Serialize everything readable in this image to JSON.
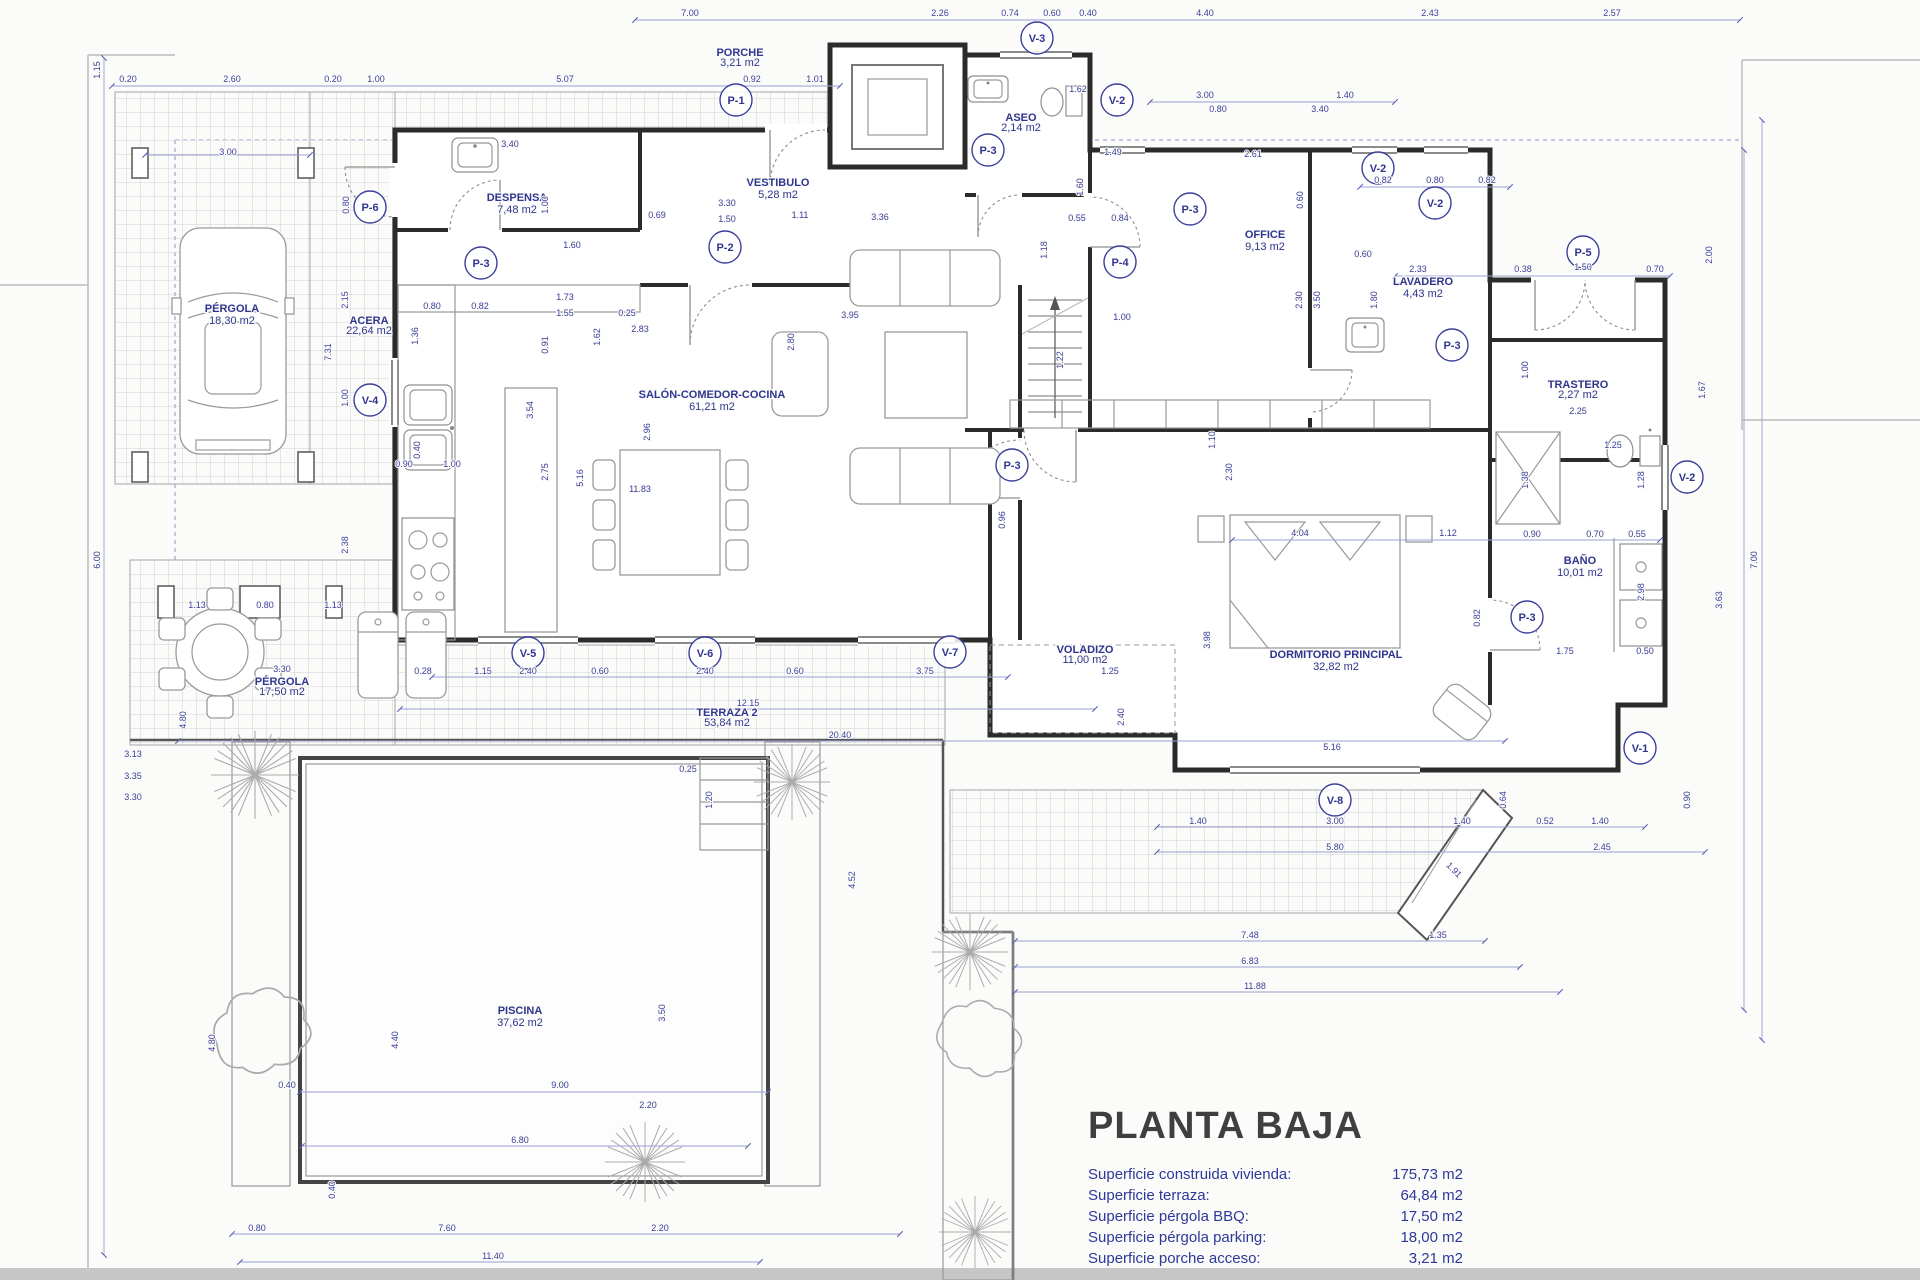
{
  "colors": {
    "annotation_blue": "#30368f",
    "dim_blue": "#3a3f99",
    "wall_dark": "#2b2b2b",
    "furniture_gray": "#9a9a9a",
    "tile_gray": "#d2d2d2",
    "background": "#fbfbfa"
  },
  "title_block": {
    "title": "PLANTA BAJA",
    "entries": [
      {
        "label": "Superficie construida vivienda:",
        "value": "175,73 m2"
      },
      {
        "label": "Superficie terraza:",
        "value": "64,84 m2"
      },
      {
        "label": "Superficie pérgola BBQ:",
        "value": "17,50 m2"
      },
      {
        "label": "Superficie pérgola parking:",
        "value": "18,00 m2"
      },
      {
        "label": "Superficie porche acceso:",
        "value": "3,21 m2"
      }
    ]
  },
  "rooms": [
    {
      "id": "porche",
      "n": "PORCHE",
      "a": "3,21 m2",
      "x": 740,
      "y": 56,
      "fs": 9
    },
    {
      "id": "vestibulo",
      "n": "VESTIBULO",
      "a": "5,28 m2",
      "x": 778,
      "y": 186
    },
    {
      "id": "despensa",
      "n": "DESPENSA",
      "a": "7,48 m2",
      "x": 517,
      "y": 201
    },
    {
      "id": "aseo",
      "n": "ASEO",
      "a": "2,14 m2",
      "x": 1021,
      "y": 121,
      "fs": 9
    },
    {
      "id": "office",
      "n": "OFFICE",
      "a": "9,13 m2",
      "x": 1265,
      "y": 238
    },
    {
      "id": "lavadero",
      "n": "LAVADERO",
      "a": "4,43 m2",
      "x": 1423,
      "y": 285
    },
    {
      "id": "trastero",
      "n": "TRASTERO",
      "a": "2,27 m2",
      "x": 1578,
      "y": 388,
      "fs": 9
    },
    {
      "id": "bano",
      "n": "BAÑO",
      "a": "10,01 m2",
      "x": 1580,
      "y": 564
    },
    {
      "id": "dormitorio",
      "n": "DORMITORIO PRINCIPAL",
      "a": "32,82 m2",
      "x": 1336,
      "y": 658
    },
    {
      "id": "salon",
      "n": "SALÓN-COMEDOR-COCINA",
      "a": "61,21 m2",
      "x": 712,
      "y": 398
    },
    {
      "id": "pergola-parking",
      "n": "PÉRGOLA",
      "a": "18,30 m2",
      "x": 232,
      "y": 312
    },
    {
      "id": "acera",
      "n": "ACERA",
      "a": "22,64 m2",
      "x": 369,
      "y": 324,
      "fs": 9
    },
    {
      "id": "pergola-bbq",
      "n": "PÉRGOLA",
      "a": "17,50 m2",
      "x": 282,
      "y": 685,
      "fs": 9
    },
    {
      "id": "terraza2",
      "n": "TERRAZA 2",
      "a": "53,84 m2",
      "x": 727,
      "y": 716,
      "fs": 9
    },
    {
      "id": "voladizo",
      "n": "VOLADIZO",
      "a": "11,00 m2",
      "x": 1085,
      "y": 653,
      "fs": 9
    },
    {
      "id": "piscina",
      "n": "PISCINA",
      "a": "37,62 m2",
      "x": 520,
      "y": 1014
    }
  ],
  "door_tags": [
    {
      "l": "P-1",
      "x": 736,
      "y": 100
    },
    {
      "l": "P-2",
      "x": 725,
      "y": 247
    },
    {
      "l": "P-3",
      "x": 481,
      "y": 263
    },
    {
      "l": "P-3",
      "x": 988,
      "y": 150
    },
    {
      "l": "P-3",
      "x": 1190,
      "y": 209
    },
    {
      "l": "P-3",
      "x": 1012,
      "y": 465
    },
    {
      "l": "P-3",
      "x": 1452,
      "y": 345
    },
    {
      "l": "P-3",
      "x": 1527,
      "y": 617
    },
    {
      "l": "P-4",
      "x": 1120,
      "y": 262
    },
    {
      "l": "P-5",
      "x": 1583,
      "y": 252
    },
    {
      "l": "P-6",
      "x": 370,
      "y": 207
    }
  ],
  "window_tags": [
    {
      "l": "V-1",
      "x": 1640,
      "y": 748
    },
    {
      "l": "V-2",
      "x": 1117,
      "y": 100
    },
    {
      "l": "V-2",
      "x": 1378,
      "y": 168
    },
    {
      "l": "V-2",
      "x": 1435,
      "y": 203
    },
    {
      "l": "V-2",
      "x": 1687,
      "y": 477
    },
    {
      "l": "V-3",
      "x": 1037,
      "y": 38
    },
    {
      "l": "V-4",
      "x": 370,
      "y": 400
    },
    {
      "l": "V-5",
      "x": 528,
      "y": 653
    },
    {
      "l": "V-6",
      "x": 705,
      "y": 653
    },
    {
      "l": "V-7",
      "x": 950,
      "y": 652
    },
    {
      "l": "V-8",
      "x": 1335,
      "y": 800
    }
  ],
  "dimensions": [
    [
      "7.00",
      690,
      16
    ],
    [
      "2.26",
      940,
      16
    ],
    [
      "0.74",
      1010,
      16
    ],
    [
      "0.60",
      1052,
      16
    ],
    [
      "0.40",
      1088,
      16
    ],
    [
      "4.40",
      1205,
      16
    ],
    [
      "2.43",
      1430,
      16
    ],
    [
      "2.57",
      1612,
      16
    ],
    [
      "0.20",
      128,
      82
    ],
    [
      "2.60",
      232,
      82
    ],
    [
      "0.20",
      333,
      82
    ],
    [
      "1.00",
      376,
      82
    ],
    [
      "5.07",
      565,
      82
    ],
    [
      "0.92",
      752,
      82
    ],
    [
      "1.01",
      815,
      82
    ],
    [
      "3.00",
      1205,
      98
    ],
    [
      "1.40",
      1345,
      98
    ],
    [
      "0.80",
      1218,
      112
    ],
    [
      "3.40",
      1320,
      112
    ],
    [
      "1.62",
      1078,
      92
    ],
    [
      "1.49",
      1113,
      155
    ],
    [
      "1.15",
      100,
      70,
      -90
    ],
    [
      "3.00",
      228,
      155
    ],
    [
      "0.80",
      349,
      205,
      -90
    ],
    [
      "2.15",
      348,
      300,
      -90
    ],
    [
      "7.31",
      331,
      352,
      -90
    ],
    [
      "1.00",
      348,
      398,
      -90
    ],
    [
      "2.38",
      348,
      545,
      -90
    ],
    [
      "6.00",
      100,
      560,
      -90
    ],
    [
      "3.40",
      510,
      147
    ],
    [
      "1.00",
      548,
      205,
      -90
    ],
    [
      "1.60",
      572,
      248
    ],
    [
      "0.69",
      657,
      218
    ],
    [
      "3.30",
      727,
      206
    ],
    [
      "1.50",
      727,
      222
    ],
    [
      "1.11",
      800,
      218
    ],
    [
      "0.80",
      432,
      309
    ],
    [
      "0.82",
      480,
      309
    ],
    [
      "1.73",
      565,
      300
    ],
    [
      "1.55",
      565,
      316
    ],
    [
      "0.25",
      627,
      316
    ],
    [
      "2.83",
      640,
      332
    ],
    [
      "3.95",
      850,
      318
    ],
    [
      "1.36",
      418,
      336,
      -90
    ],
    [
      "0.40",
      420,
      450,
      -90
    ],
    [
      "0.91",
      548,
      345,
      -90
    ],
    [
      "1.62",
      600,
      337,
      -90
    ],
    [
      "2.80",
      794,
      342,
      -90
    ],
    [
      "2.75",
      548,
      472,
      -90
    ],
    [
      "5.16",
      583,
      478,
      -90
    ],
    [
      "3.54",
      533,
      410,
      -90
    ],
    [
      "2.96",
      650,
      432,
      -90
    ],
    [
      "0.90",
      404,
      467
    ],
    [
      "1.00",
      452,
      467
    ],
    [
      "11.83",
      640,
      492
    ],
    [
      "3.36",
      880,
      220
    ],
    [
      "0.55",
      1077,
      221
    ],
    [
      "0.84",
      1120,
      221
    ],
    [
      "1.60",
      1083,
      187,
      -90
    ],
    [
      "1.18",
      1047,
      250,
      -90
    ],
    [
      "1.00",
      1122,
      320
    ],
    [
      "1.22",
      1063,
      360,
      -90
    ],
    [
      "2.61",
      1253,
      157
    ],
    [
      "0.82",
      1383,
      183
    ],
    [
      "0.80",
      1435,
      183
    ],
    [
      "0.82",
      1487,
      183
    ],
    [
      "0.60",
      1303,
      200,
      -90
    ],
    [
      "2.30",
      1302,
      300,
      -90
    ],
    [
      "3.50",
      1320,
      300,
      -90
    ],
    [
      "0.60",
      1363,
      257
    ],
    [
      "2.33",
      1418,
      272
    ],
    [
      "1.80",
      1377,
      300,
      -90
    ],
    [
      "0.38",
      1523,
      272
    ],
    [
      "1.50",
      1583,
      270
    ],
    [
      "0.70",
      1655,
      272
    ],
    [
      "2.25",
      1578,
      414
    ],
    [
      "1.00",
      1528,
      370,
      -90
    ],
    [
      "1.38",
      1528,
      480,
      -90
    ],
    [
      "1.25",
      1613,
      448
    ],
    [
      "1.28",
      1644,
      480,
      -90
    ],
    [
      "2.98",
      1644,
      592,
      -90
    ],
    [
      "0.90",
      1532,
      537
    ],
    [
      "0.70",
      1595,
      537
    ],
    [
      "0.55",
      1637,
      537
    ],
    [
      "1.75",
      1565,
      654
    ],
    [
      "0.50",
      1645,
      654
    ],
    [
      "0.82",
      1480,
      618,
      -90
    ],
    [
      "4.04",
      1300,
      536
    ],
    [
      "1.12",
      1448,
      536
    ],
    [
      "1.10",
      1215,
      440,
      -90
    ],
    [
      "2.30",
      1232,
      472,
      -90
    ],
    [
      "3.98",
      1210,
      640,
      -90
    ],
    [
      "5.16",
      1332,
      750
    ],
    [
      "0.96",
      1005,
      520,
      -90
    ],
    [
      "1.25",
      1110,
      674
    ],
    [
      "2.40",
      1124,
      717,
      -90
    ],
    [
      "2.40",
      528,
      674
    ],
    [
      "0.60",
      600,
      674
    ],
    [
      "2.40",
      705,
      674
    ],
    [
      "0.60",
      795,
      674
    ],
    [
      "3.75",
      925,
      674
    ],
    [
      "12.15",
      748,
      706
    ],
    [
      "20.40",
      840,
      738
    ],
    [
      "3.30",
      282,
      672
    ],
    [
      "0.28",
      423,
      674
    ],
    [
      "1.15",
      483,
      674
    ],
    [
      "1.13",
      197,
      608
    ],
    [
      "0.80",
      265,
      608
    ],
    [
      "1.13",
      333,
      608
    ],
    [
      "4.80",
      186,
      720,
      -90
    ],
    [
      "1.40",
      1198,
      824
    ],
    [
      "3.00",
      1335,
      824
    ],
    [
      "1.40",
      1462,
      824
    ],
    [
      "5.80",
      1335,
      850
    ],
    [
      "0.52",
      1545,
      824
    ],
    [
      "1.40",
      1600,
      824
    ],
    [
      "2.45",
      1602,
      850
    ],
    [
      "0.64",
      1506,
      800,
      -90
    ],
    [
      "1.91",
      1452,
      872,
      45
    ],
    [
      "1.35",
      1438,
      938
    ],
    [
      "7.48",
      1250,
      938
    ],
    [
      "6.83",
      1250,
      964
    ],
    [
      "11.88",
      1255,
      989
    ],
    [
      "2.00",
      1712,
      255,
      -90
    ],
    [
      "1.67",
      1705,
      390,
      -90
    ],
    [
      "7.00",
      1757,
      560,
      -90
    ],
    [
      "3.63",
      1722,
      600,
      -90
    ],
    [
      "0.90",
      1690,
      800,
      -90
    ],
    [
      "9.00",
      560,
      1088
    ],
    [
      "6.80",
      520,
      1143
    ],
    [
      "2.20",
      648,
      1108
    ],
    [
      "0.40",
      287,
      1088
    ],
    [
      "0.40",
      335,
      1190,
      -90
    ],
    [
      "4.40",
      398,
      1040,
      -90
    ],
    [
      "4.80",
      215,
      1043,
      -90
    ],
    [
      "3.50",
      665,
      1013,
      -90
    ],
    [
      "0.25",
      688,
      772
    ],
    [
      "1.20",
      712,
      800,
      -90
    ],
    [
      "0.80",
      257,
      1231
    ],
    [
      "7.60",
      447,
      1231
    ],
    [
      "2.20",
      660,
      1231
    ],
    [
      "11.40",
      493,
      1259
    ],
    [
      "3.13",
      133,
      757
    ],
    [
      "3.35",
      133,
      779
    ],
    [
      "3.30",
      133,
      800
    ],
    [
      "4.52",
      855,
      880,
      -90
    ]
  ]
}
